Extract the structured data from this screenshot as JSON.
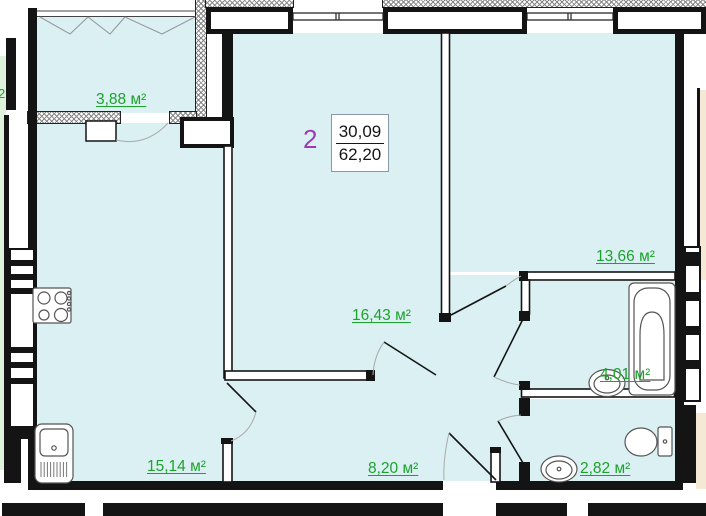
{
  "floor_plan": {
    "summary": {
      "rooms_count": "2",
      "living_area": "30,09",
      "total_area": "62,20"
    },
    "room_labels": {
      "balcony": "3,88 м²",
      "kitchen": "15,14 м²",
      "living_room": "16,43 м²",
      "bedroom": "13,66 м²",
      "bathroom": "4,01 м²",
      "wc": "2,82 м²",
      "hallway": "8,20 м²"
    },
    "neighbor_label_fragment": "2",
    "colors": {
      "area_label_green": "#1ca32b",
      "summary_purple": "#a03ab4",
      "room_fill_cyan": "#daf0f3",
      "neighbor_fill_left_green": "#dff2dc",
      "neighbor_fill_right_beige": "#f3e9d4",
      "wall_black": "#141414"
    }
  }
}
